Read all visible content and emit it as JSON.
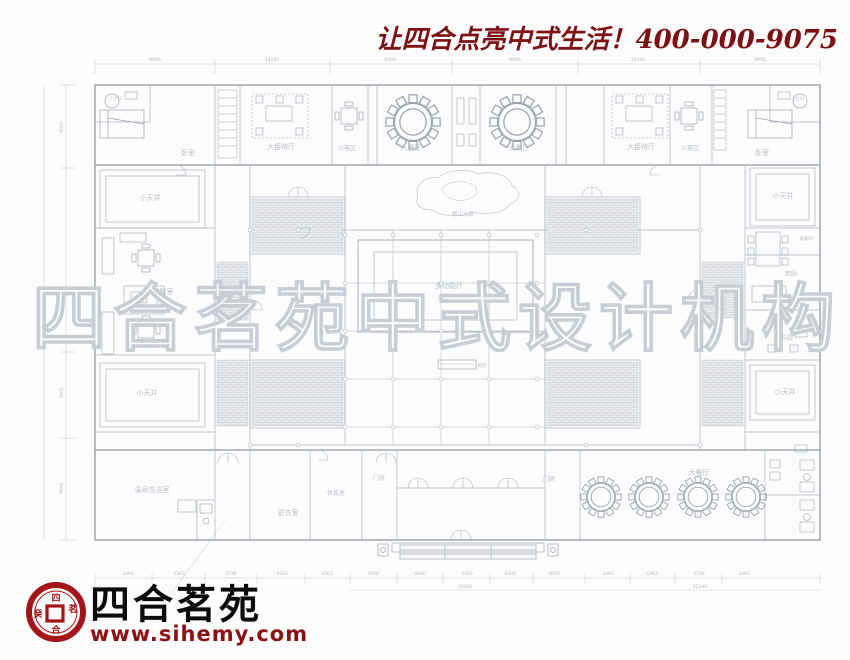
{
  "header": {
    "slogan": "让四合点亮中式生活！400-000-9075"
  },
  "watermark": {
    "text": "四合茗苑中式设计机构"
  },
  "logo": {
    "brand": "四合茗苑",
    "website": "www.sihemy.com",
    "seal_chars": "四合茗苑"
  },
  "colors": {
    "accent_red": "#7d1013",
    "logo_red": "#a31518",
    "line": "#a7b0bc",
    "wall": "#8f99a6",
    "label": "#b6bec8",
    "hatch": "#c6ccd3"
  },
  "plan": {
    "rooms": [
      {
        "label": "卧室"
      },
      {
        "label": "大接待厅"
      },
      {
        "label": "公客区"
      },
      {
        "label": "大餐厅"
      },
      {
        "label": "大餐厅"
      },
      {
        "label": "大接待厅"
      },
      {
        "label": "公客区"
      },
      {
        "label": "卧室"
      },
      {
        "label": "小天井"
      },
      {
        "label": "小天井"
      },
      {
        "label": "假山水景"
      },
      {
        "label": "棋牌室"
      },
      {
        "label": "西厨"
      },
      {
        "label": "中厨"
      },
      {
        "label": "多功能厅"
      },
      {
        "label": "小天井"
      },
      {
        "label": "小天井"
      },
      {
        "label": "温泉洗浴室"
      },
      {
        "label": "更衣室"
      },
      {
        "label": "休息室"
      },
      {
        "label": "门房"
      },
      {
        "label": "门房"
      },
      {
        "label": "大餐厅"
      },
      {
        "label": "备餐间"
      },
      {
        "label": "卫生间"
      },
      {
        "label": "卫生间"
      },
      {
        "label": "照壁"
      }
    ],
    "dims": {
      "top": [
        "9000",
        "14100",
        "9000",
        "9000",
        "14100",
        "9000"
      ],
      "left": [
        "6000",
        "12700",
        "3900",
        "9000"
      ],
      "left_total": "61700",
      "bottom": [
        "4364",
        "4363",
        "4736",
        "4363",
        "4363",
        "4000",
        "4000",
        "4300",
        "4000",
        "4000",
        "4363",
        "4363",
        "4736",
        "4363"
      ],
      "bottom_totals": [
        "20300",
        "22190"
      ]
    }
  }
}
